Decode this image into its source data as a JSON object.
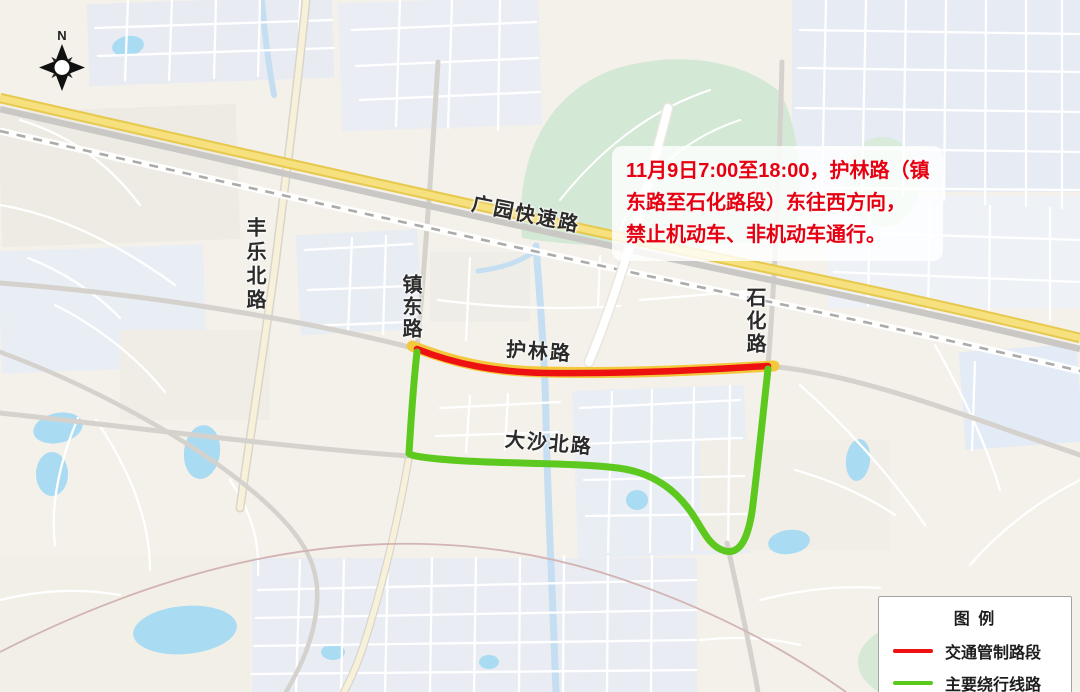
{
  "compass": {
    "north_label": "N"
  },
  "roads": {
    "fengle_north": "丰乐北路",
    "guangyuan_expressway": "广园快速路",
    "zhendong": "镇东路",
    "shihua": "石化路",
    "hulin": "护林路",
    "dashabei": "大沙北路"
  },
  "notice": {
    "lines": [
      "11月9日7:00至18:00，护林路（镇",
      "东路至石化路段）东往西方向，",
      "禁止机动车、非机动车通行。"
    ],
    "text_color": "#e60012"
  },
  "legend": {
    "title": "图 例",
    "items": [
      {
        "label": "交通管制路段",
        "color": "#ee1111"
      },
      {
        "label": "主要绕行线路",
        "color": "#5dc91e"
      }
    ]
  },
  "map_colors": {
    "background": "#f4f1ea",
    "blocks_blue": "#e8ebf2",
    "park_green": "#d3e8d5",
    "water_blue": "#a9dbf2",
    "expressway_yellow": "#f7e07e",
    "road_gray": "#d5d2cd"
  }
}
